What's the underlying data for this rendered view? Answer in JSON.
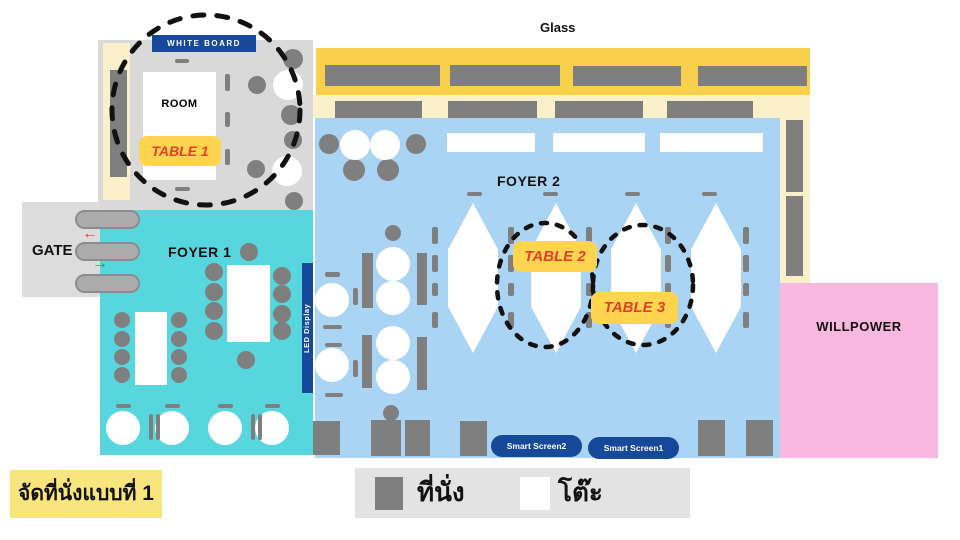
{
  "labels": {
    "glass": "Glass",
    "white_board": "WHITE BOARD",
    "room": "ROOM",
    "gate": "GATE",
    "foyer1": "FOYER 1",
    "foyer2": "FOYER 2",
    "led_display": "LED Display",
    "willpower": "WILLPOWER"
  },
  "table_badges": {
    "table1": "TABLE 1",
    "table2": "TABLE 2",
    "table3": "TABLE 3",
    "bg_color": "#FFD44F",
    "text_color": "#E2402F"
  },
  "smart_screens": {
    "screen2": "Smart Screen2",
    "screen1": "Smart Screen1",
    "bg_color": "#17499B"
  },
  "legend": {
    "seat_label": "ที่นั่ง",
    "table_label": "โต๊ะ",
    "seat_color": "#7F7F7F",
    "table_color": "#FFFFFF"
  },
  "title_badge": {
    "text": "จัดที่นั่งแบบที่ 1",
    "bg_color": "#F9E57D"
  },
  "gate": {
    "arrow_in": "→",
    "arrow_out": "←",
    "in_color": "#169B4A",
    "out_color": "#E8392E"
  },
  "colors": {
    "foyer1_teal": "#57D6DD",
    "foyer2_blue": "#A9D4F4",
    "glass_yellow": "#F8D04B",
    "corridor_cream": "#FAF0CA",
    "room_gray": "#D9D9D9",
    "seat_gray": "#7F7F7F",
    "willpower_pink": "#F9B8DF",
    "navy_blue": "#17499B",
    "legend_bg": "#E3E3E3"
  }
}
